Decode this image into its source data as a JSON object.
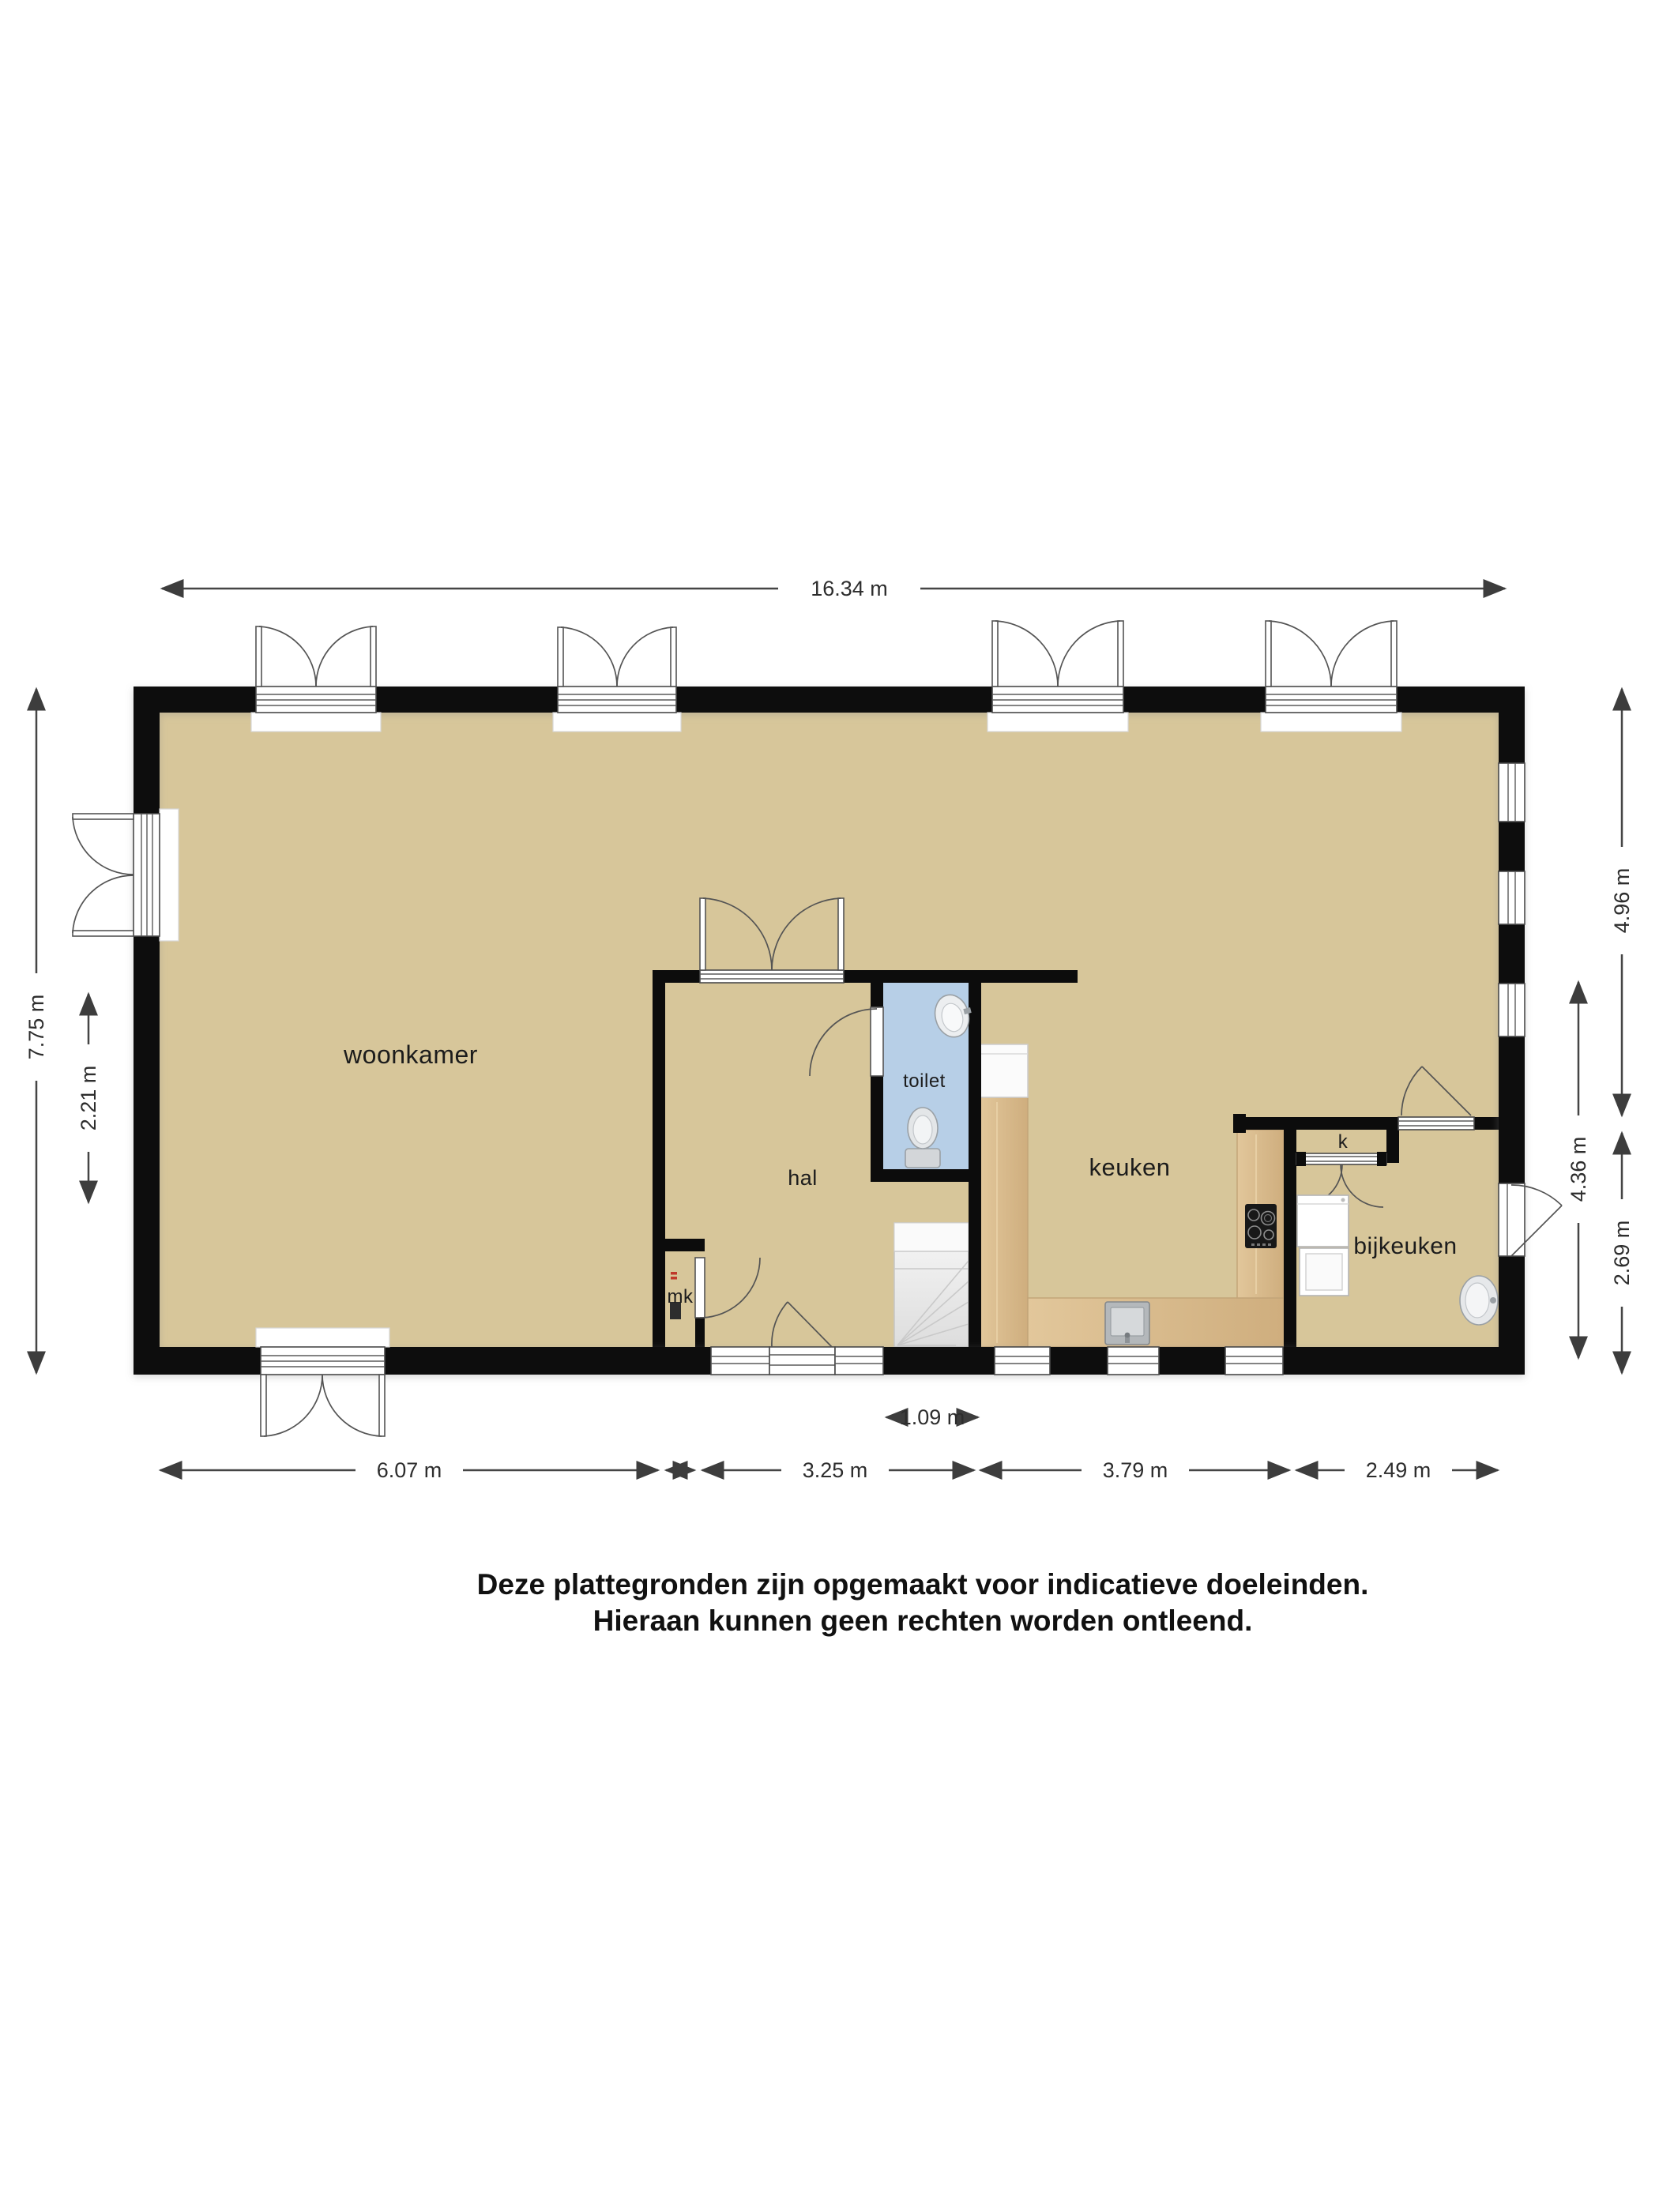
{
  "plan": {
    "type": "floorplan-ground-floor",
    "rooms": {
      "woonkamer": "woonkamer",
      "hal": "hal",
      "toilet": "toilet",
      "keuken": "keuken",
      "bijkeuken": "bijkeuken",
      "closet": "k",
      "meter_closet": "mk"
    },
    "dimensions": {
      "total_width": "16.34 m",
      "total_height": "7.75 m",
      "left_inner": "2.21 m",
      "right_top": "4.96 m",
      "right_middle": "4.36 m",
      "right_bottom": "2.69 m",
      "bottom": [
        "6.07 m",
        "3.25 m",
        "3.79 m",
        "2.49 m"
      ],
      "toilet_width": "1.09 m"
    },
    "fixtures": [
      "stairs-icon",
      "toilet-bowl-icon",
      "hand-basin-icon",
      "kitchen-sink-icon",
      "cooktop-icon",
      "washer-icon",
      "dryer-icon",
      "utility-sink-icon",
      "meter-box-icon"
    ],
    "colors": {
      "floor": "#d7c69a",
      "toilet_floor": "#b7cfe7",
      "counter_wood": "#dcbf92",
      "wall": "#0c0c0c",
      "dimension_line": "#454545",
      "stairs": "#efefef"
    }
  },
  "disclaimer": {
    "line1": "Deze plattegronden zijn opgemaakt voor indicatieve doeleinden.",
    "line2": "Hieraan kunnen geen rechten worden ontleend."
  }
}
